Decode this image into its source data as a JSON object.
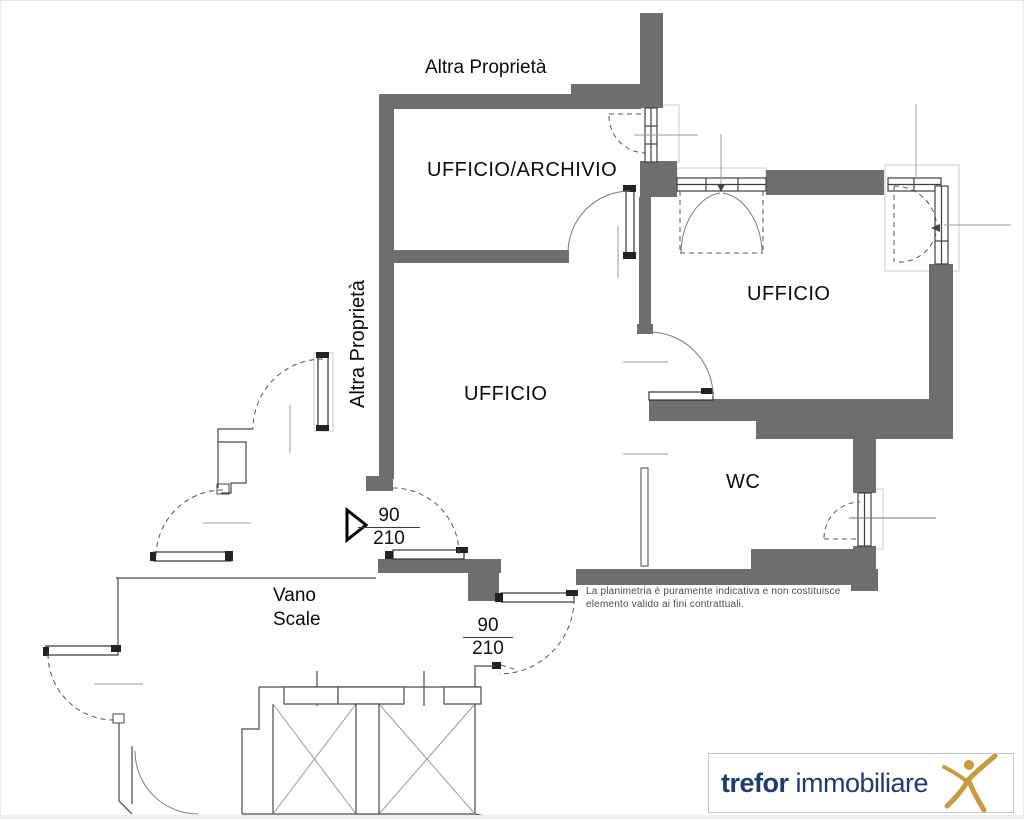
{
  "plan": {
    "labels": {
      "other_property_top": "Altra Proprietà",
      "other_property_side": "Altra Proprietà",
      "room_office_archive": "UFFICIO/ARCHIVIO",
      "room_office_center": "UFFICIO",
      "room_office_right": "UFFICIO",
      "room_wc": "WC",
      "stairwell_line1": "Vano",
      "stairwell_line2": "Scale"
    },
    "doors": {
      "door1": {
        "width_cm": "90",
        "height_cm": "210"
      },
      "door2": {
        "width_cm": "90",
        "height_cm": "210"
      }
    },
    "disclaimer_line1": "La planimetria è puramente indicativa e non costituisce",
    "disclaimer_line2": "elemento valido ai fini contrattuali.",
    "colors": {
      "wall_fill": "#6e6e6e",
      "thin_line": "#4a4a4a"
    }
  },
  "logo": {
    "brand_bold": "trefor",
    "brand_light": "immobiliare",
    "navy": "#1d3c72",
    "gold": "#c79b3e"
  }
}
